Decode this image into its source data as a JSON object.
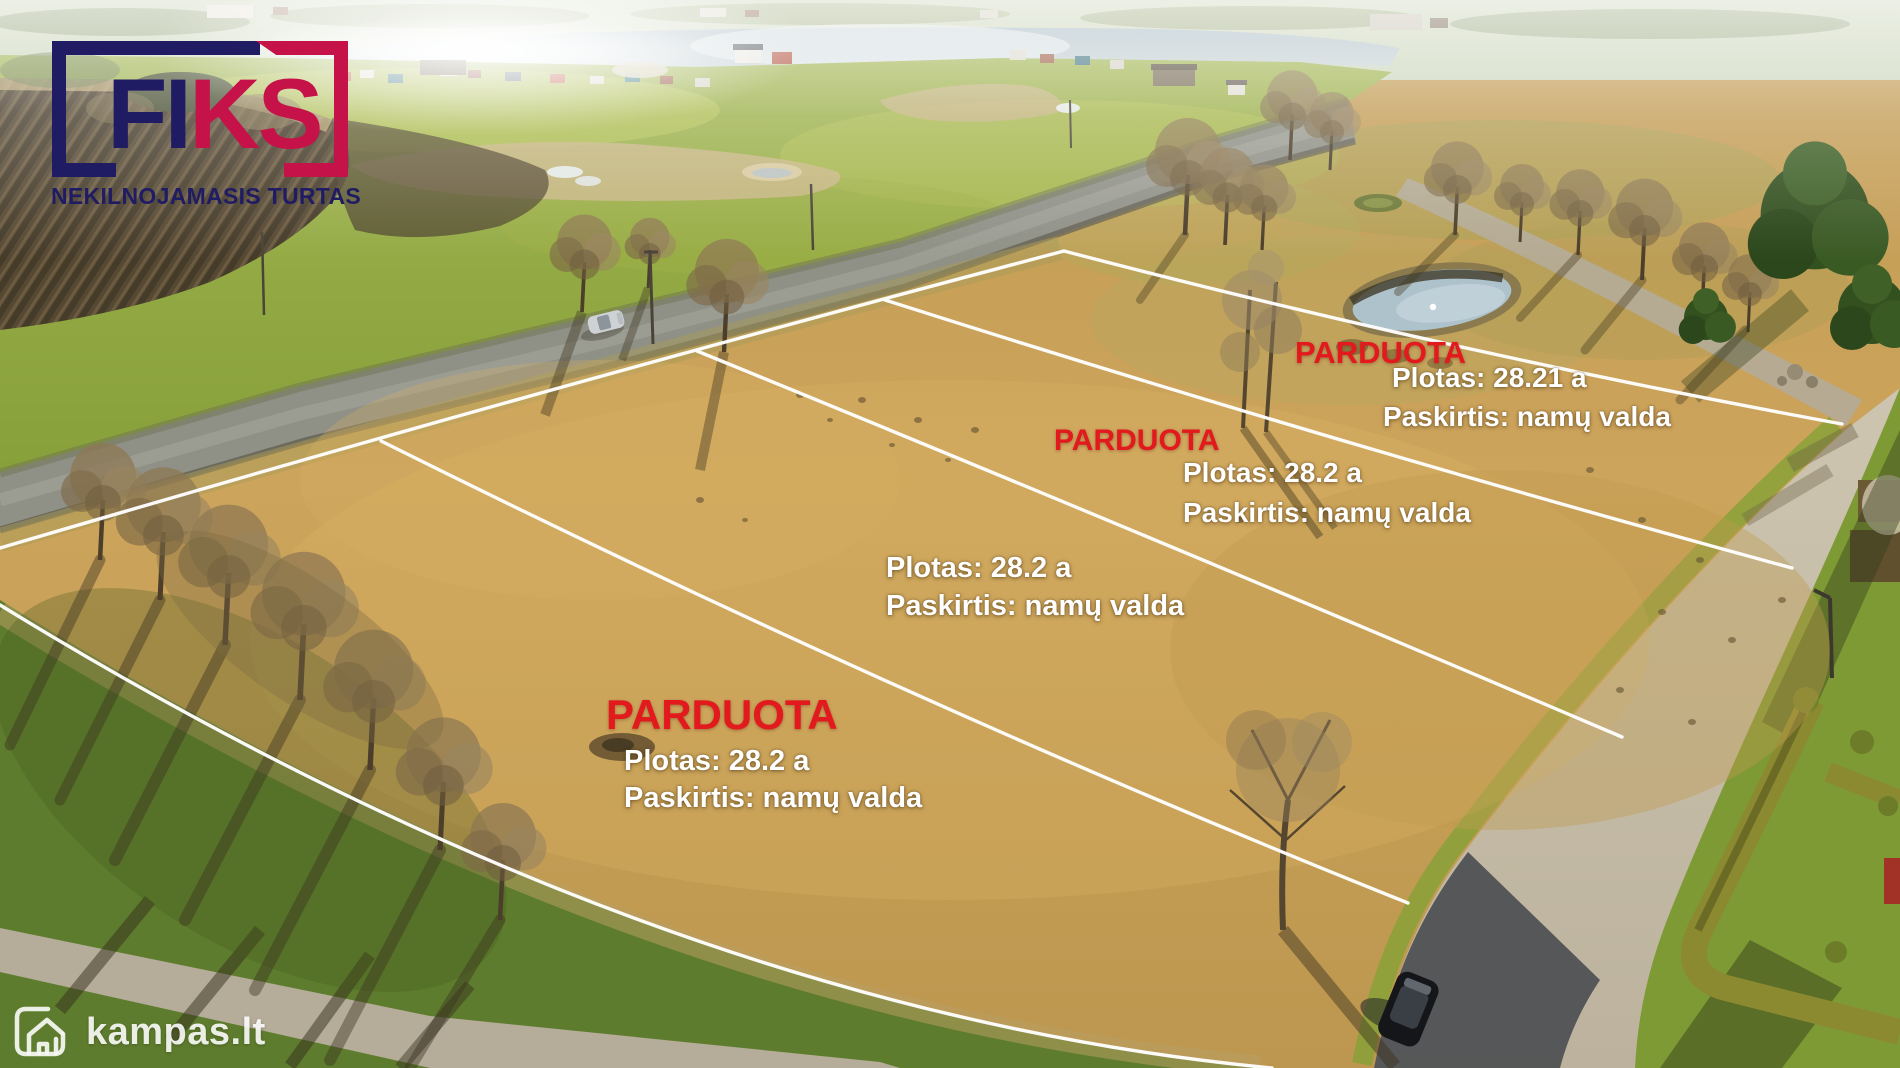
{
  "branding": {
    "logo_part1": "FI",
    "logo_part2": "KS",
    "tagline": "NEKILNOJAMASIS TURTAS",
    "navy": "#201c63",
    "crimson": "#c51349"
  },
  "colors": {
    "sold_red": "#e2191d",
    "label_white": "#ffffff"
  },
  "plots": [
    {
      "id": 1,
      "status": "PARDUOTA",
      "area_label": "Plotas: 28.21 a",
      "area_a": "28.21",
      "purpose_label": "Paskirtis: namų valda"
    },
    {
      "id": 2,
      "status": "PARDUOTA",
      "area_label": "Plotas: 28.2 a",
      "area_a": "28.2",
      "purpose_label": "Paskirtis: namų valda"
    },
    {
      "id": 3,
      "status": "",
      "area_label": "Plotas: 28.2 a",
      "area_a": "28.2",
      "purpose_label": "Paskirtis: namų valda"
    },
    {
      "id": 4,
      "status": "PARDUOTA",
      "area_label": "Plotas: 28.2 a",
      "area_a": "28.2",
      "purpose_label": "Paskirtis: namų valda"
    }
  ],
  "watermark": {
    "text": "kampas.lt"
  }
}
